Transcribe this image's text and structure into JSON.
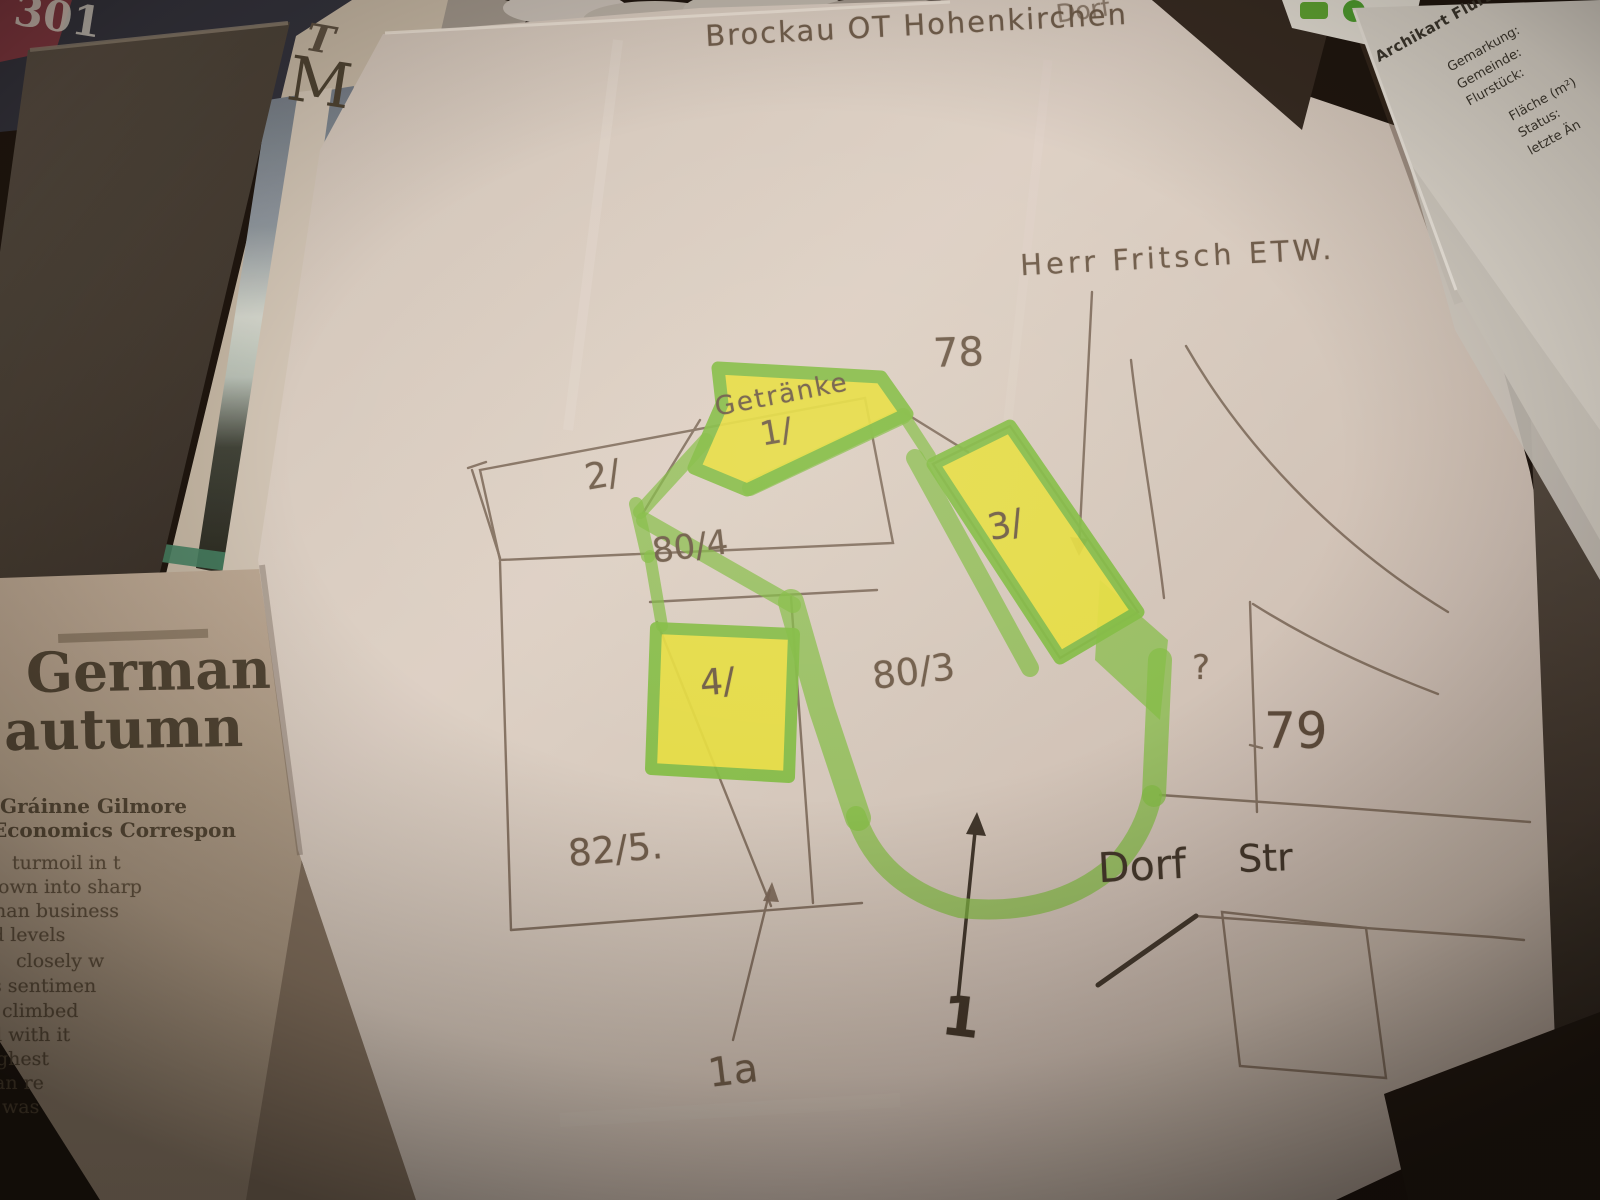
{
  "sketch": {
    "title": "Brockau OT Hohenkirchen",
    "title_fragment": "Dorf",
    "owner_note": "Herr Fritsch ETW.",
    "street": {
      "word1": "Dorf",
      "word2": "Str"
    },
    "parcel_labels": {
      "p78": "78",
      "p79": "79",
      "p80_3": "80/3",
      "p80_4": "80/4",
      "p82_5": "82/5.",
      "p2": "2/",
      "unknown": "?"
    },
    "building_labels": {
      "b1_name": "Getränke",
      "b1": "1/",
      "b3": "3/",
      "b4": "4/"
    },
    "callouts": {
      "c1a": "1a",
      "c1": "1"
    }
  },
  "newspaper": {
    "masthead_initial": "T",
    "headline_initial": "M",
    "headline_line1": "German",
    "headline_line2": "autumn",
    "byline": "Gráinne Gilmore",
    "byline_role": "Economics Correspon",
    "body_fragments": [
      "turmoil in t",
      "own into sharp",
      "nan business",
      "d levels",
      "closely w",
      "s sentimen",
      "climbed",
      "d with it",
      "ghest",
      "an re",
      "was"
    ]
  },
  "magazine": {
    "masthead_fragment": "301"
  },
  "document": {
    "title": "Archikart Flurstücks",
    "fields_block1": [
      "Gemarkung:",
      "Gemeinde:",
      "Flurstück:"
    ],
    "fields_block2": [
      "Fläche (m²)",
      "Status:",
      "letzte Än"
    ]
  },
  "colors": {
    "marker_green": "#7fbe45",
    "highlight_yellow": "#e6e041",
    "pencil": "#756458",
    "ink": "#453c33",
    "paper": "#d7ccc5"
  }
}
